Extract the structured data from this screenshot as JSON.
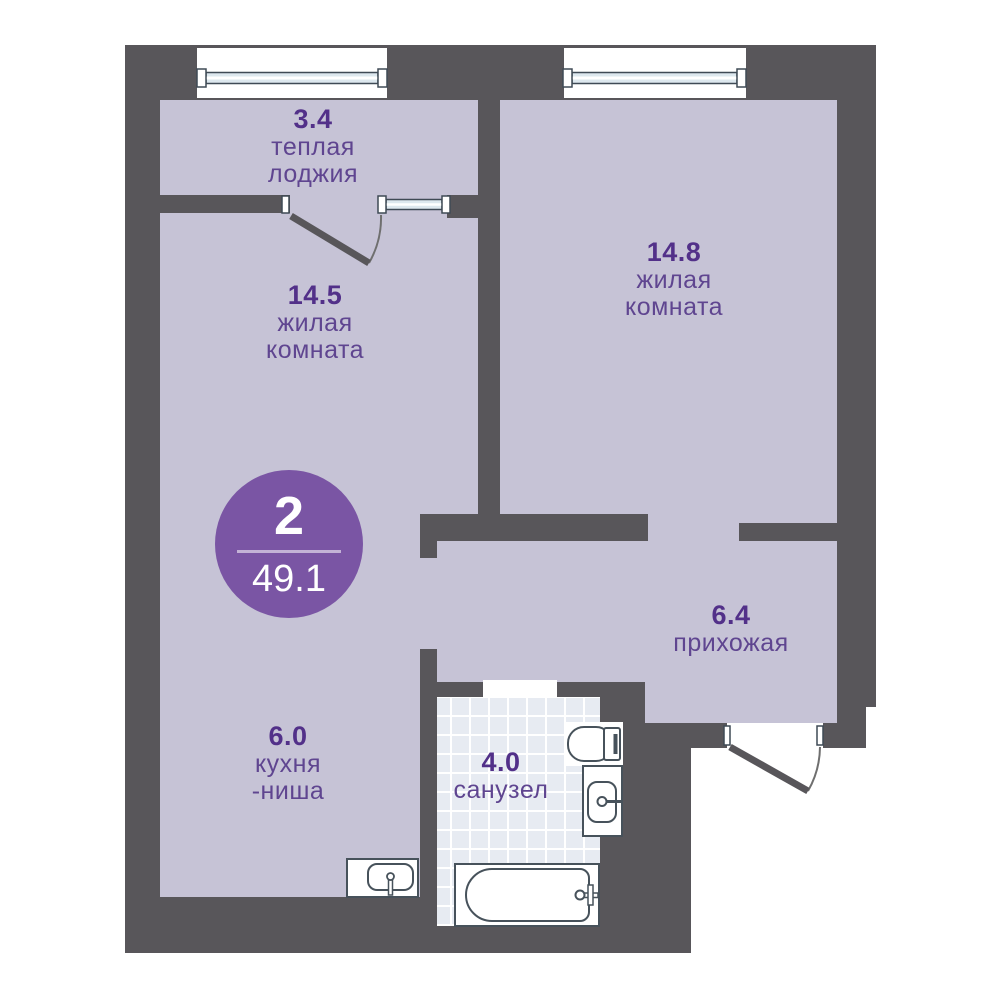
{
  "badge": {
    "rooms_count": "2",
    "total_area": "49.1"
  },
  "rooms": {
    "loggia": {
      "area": "3.4",
      "line1": "теплая",
      "line2": "лоджия"
    },
    "living1": {
      "area": "14.5",
      "line1": "жилая",
      "line2": "комната"
    },
    "living2": {
      "area": "14.8",
      "line1": "жилая",
      "line2": "комната"
    },
    "hall": {
      "area": "6.4",
      "line1": "прихожая"
    },
    "kitchen": {
      "area": "6.0",
      "line1": "кухня",
      "line2": "-ниша"
    },
    "bathroom": {
      "area": "4.0",
      "line1": "санузел"
    }
  },
  "fixtures": [
    "window-icon",
    "door-icon",
    "toilet-icon",
    "washbasin-icon",
    "bathtub-icon",
    "kitchen-sink-icon"
  ],
  "colors": {
    "wall": "#58565a",
    "floor": "#c6c3d6",
    "tile": "#e7ebf2",
    "number_text": "#523089",
    "name_text": "#5f4590",
    "accent": "#7a55a4"
  }
}
